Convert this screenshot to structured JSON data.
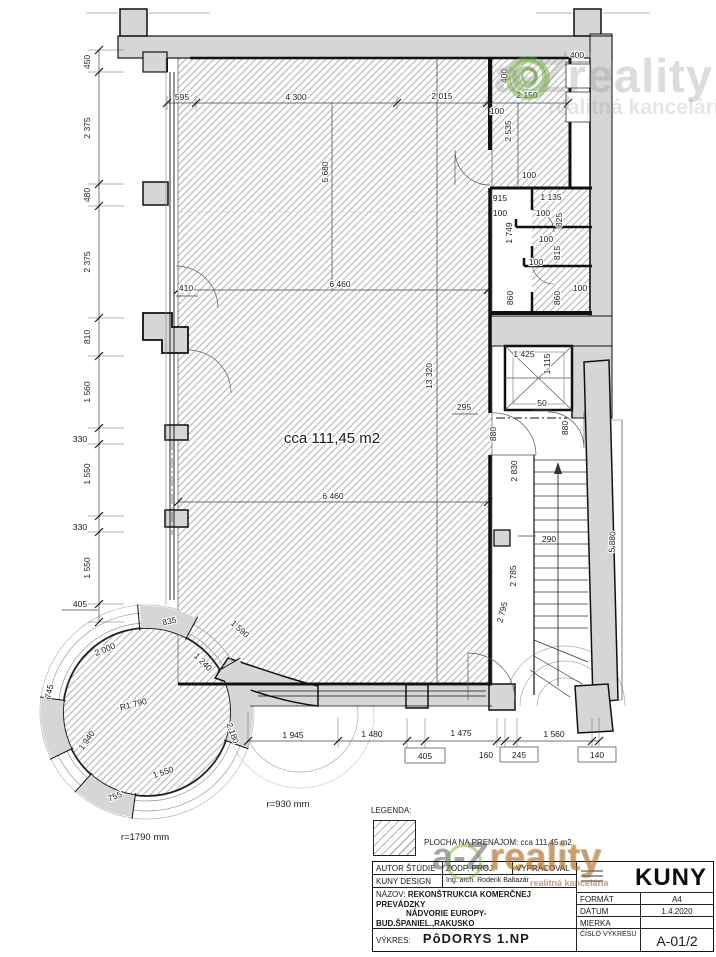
{
  "plan": {
    "dims": {
      "left": [
        "450",
        "2 375",
        "480",
        "2 375",
        "810",
        "1 560",
        "330",
        "1 550",
        "330",
        "1 550",
        "405"
      ],
      "top": [
        "595",
        "4 300",
        "2 015",
        "2 150"
      ],
      "top_right": [
        "400",
        "400",
        "100",
        "2 535",
        "100"
      ],
      "rooms": [
        "915",
        "1 135",
        "100",
        "100",
        "825",
        "1 749",
        "100",
        "815",
        "100",
        "100",
        "860",
        "860"
      ],
      "elevator": [
        "1 425",
        "1 115"
      ],
      "middle": [
        "6 460",
        "5 680",
        "13 320",
        "410",
        "6 460",
        "295",
        "50"
      ],
      "stair": [
        "880",
        "880",
        "2 830",
        "290",
        "2 785",
        "2 795",
        "5 880"
      ],
      "bottom": [
        "1 945",
        "1 480",
        "1 475",
        "1 560"
      ],
      "bottom_sub": [
        "405",
        "160",
        "245",
        "140"
      ],
      "tower": [
        "835",
        "1 590",
        "2 000",
        "1 240",
        "745",
        "R1 790",
        "2 180",
        "1 940",
        "1 550",
        "755"
      ]
    },
    "notes": {
      "area": "cca 111,45 m2",
      "tower_radius": "r=1790 mm",
      "entry_radius": "r=930 mm"
    }
  },
  "legend": {
    "title": "LEGENDA:",
    "hatch_label": "PLOCHA NA PRENÁJOM: cca 111,45 m2"
  },
  "titleblock": {
    "author_label": "AUTOR ŠTÚDIE",
    "zodp_label": "ZODP. PROJ.",
    "vyprac_label": "VYPRACOVAL",
    "studio": "KUNY DESIGN",
    "designer": "Ing. arch. Roderik Baltazár",
    "nazov_label": "NÁZOV:",
    "nazov_line1": "REKONŠTRUKCIA KOMERČNEJ PREVÁDZKY",
    "nazov_line2": "NÁDVORIE EUROPY- BUD.ŠPANIEL.,RAKUSKO",
    "nazov_line3": "KOMÁRNO",
    "investor_label": "INVESTOR:",
    "investor": "LS real s.r.o., Československej armády 29, 93401 Levice",
    "vykres_label": "VÝKRES:",
    "vykres": "PôDORYS 1.NP",
    "format_label": "FORMÁT",
    "format_value": "A4",
    "datum_label": "DÁTUM",
    "datum_value": "1.4.2020",
    "mierka_label": "MIERKA",
    "mierka_value": "",
    "cislo_label": "ČÍSLO VÝKRESU",
    "cislo_value": "A-01/2",
    "logo_text": "KUNY"
  },
  "watermark": {
    "brand": "a-Zreality",
    "brand_prefix": "a-Z",
    "brand_suffix": "reality",
    "sub": "realitná kancelária"
  }
}
